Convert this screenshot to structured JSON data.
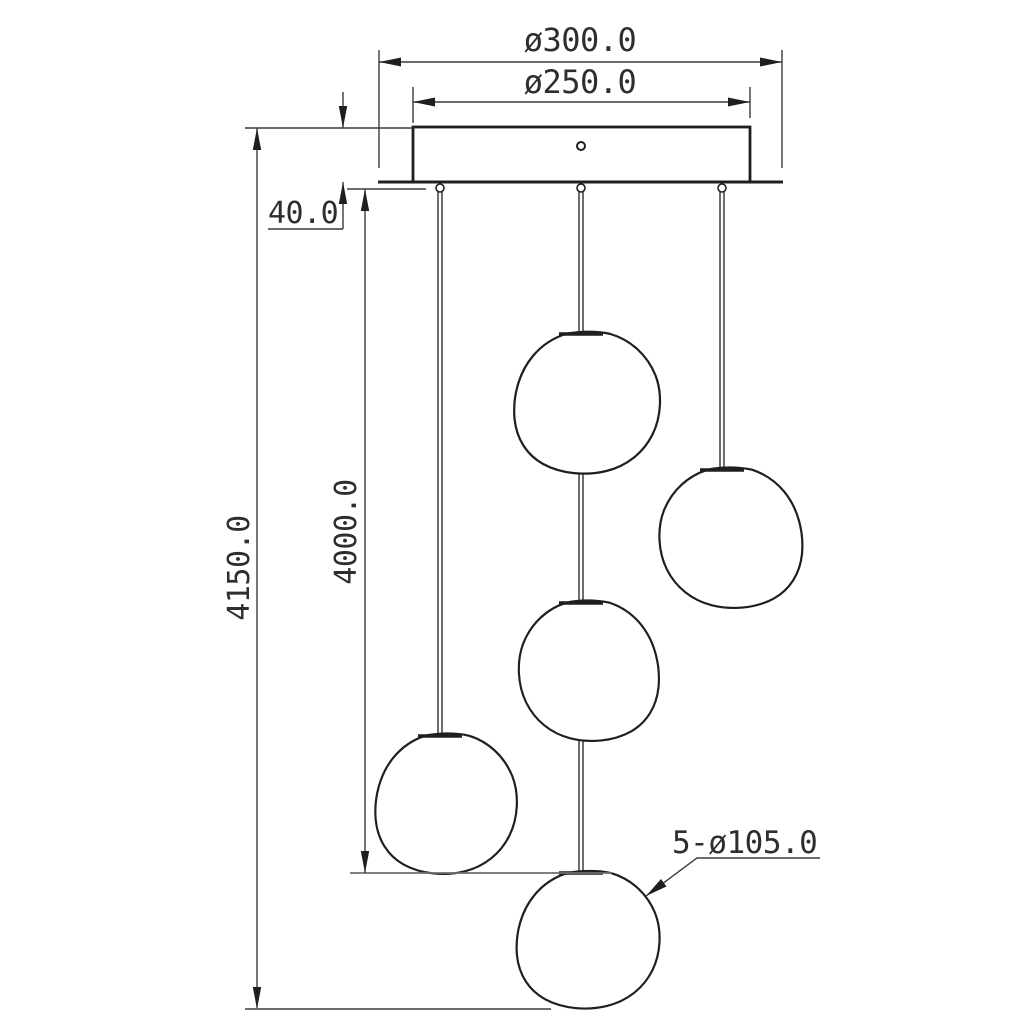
{
  "drawing": {
    "type": "technical-dimension-drawing",
    "subject": "5-light cluster pendant chandelier elevation",
    "colors": {
      "background": "#ffffff",
      "object_line": "#1f1f1f",
      "dimension_line": "#3c3c3c",
      "reference_line": "#6e6e6e"
    },
    "components": {
      "canopy": "ceiling canopy plate with center mounting hole",
      "cord_count": 3,
      "globe_count": 5
    },
    "dimensions": {
      "canopy_outer_diameter": {
        "label": "ø300.0",
        "value": 300.0,
        "unit": "mm"
      },
      "canopy_inner_diameter": {
        "label": "ø250.0",
        "value": 250.0,
        "unit": "mm"
      },
      "canopy_height": {
        "label": "40.0",
        "value": 40.0,
        "unit": "mm"
      },
      "overall_drop": {
        "label": "4150.0",
        "value": 4150.0,
        "unit": "mm"
      },
      "cord_drop": {
        "label": "4000.0",
        "value": 4000.0,
        "unit": "mm"
      },
      "globe_diameter": {
        "label": "5-ø105.0",
        "count": 5,
        "value": 105.0,
        "unit": "mm"
      }
    }
  }
}
